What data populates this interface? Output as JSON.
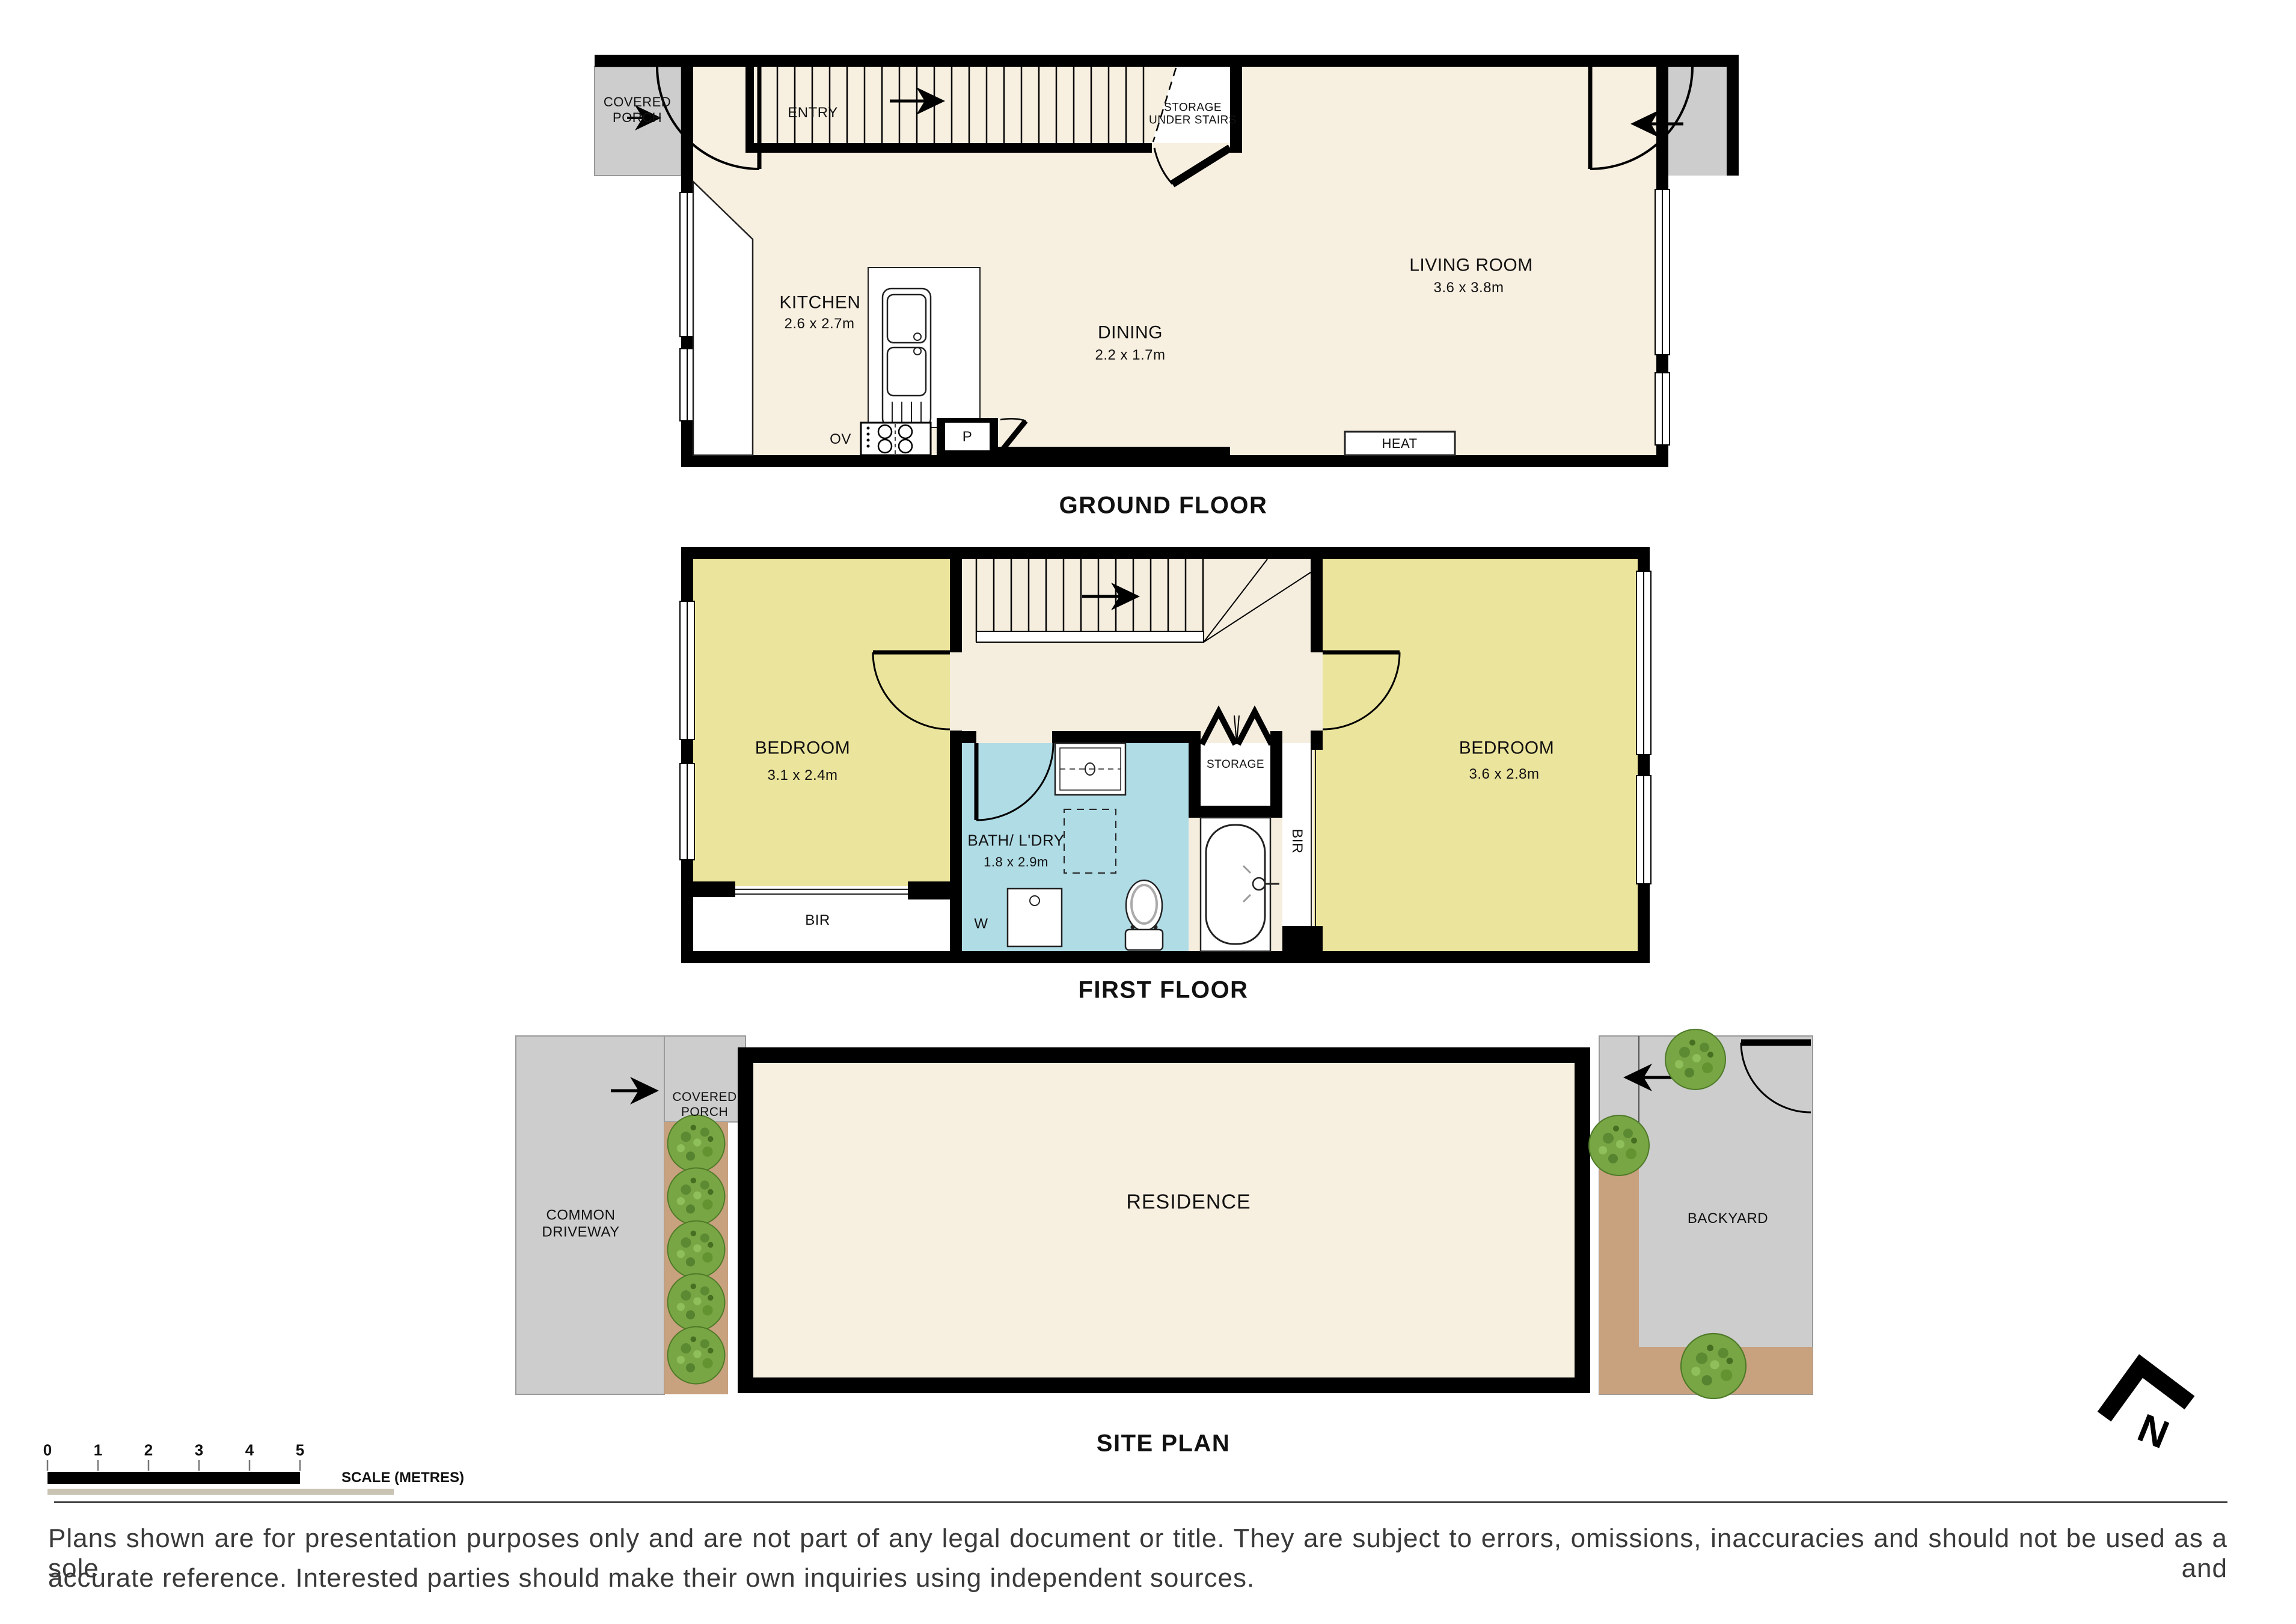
{
  "ground_floor": {
    "title": "GROUND FLOOR",
    "covered_porch": "COVERED\nPORCH",
    "entry": "ENTRY",
    "storage_under_stairs": "STORAGE\nUNDER STAIRS",
    "living_room": {
      "name": "LIVING ROOM",
      "dims": "3.6 x 3.8m"
    },
    "kitchen": {
      "name": "KITCHEN",
      "dims": "2.6 x 2.7m"
    },
    "dining": {
      "name": "DINING",
      "dims": "2.2 x 1.7m"
    },
    "oven": "OV",
    "pantry": "P",
    "heater": "HEAT"
  },
  "first_floor": {
    "title": "FIRST FLOOR",
    "bedroom_left": {
      "name": "BEDROOM",
      "dims": "3.1 x 2.4m"
    },
    "bedroom_right": {
      "name": "BEDROOM",
      "dims": "3.6 x 2.8m"
    },
    "bath": {
      "name": "BATH/ L'DRY",
      "dims": "1.8 x 2.9m"
    },
    "storage": "STORAGE",
    "bir_right": "BIR",
    "bir_left": "BIR",
    "washer": "W"
  },
  "site_plan": {
    "title": "SITE PLAN",
    "covered_porch": "COVERED\nPORCH",
    "common_driveway": "COMMON\nDRIVEWAY",
    "residence": "RESIDENCE",
    "backyard": "BACKYARD"
  },
  "scale_bar": {
    "ticks": [
      "0",
      "1",
      "2",
      "3",
      "4",
      "5"
    ],
    "label": "SCALE (METRES)"
  },
  "north": {
    "label": "N"
  },
  "disclaimer": {
    "line1": "Plans shown are for presentation purposes only and are not part of any legal document or title. They are subject to errors, omissions, inaccuracies and should not be used as a sole and",
    "line2": "accurate reference. Interested parties should make their own inquiries using independent sources."
  },
  "colors": {
    "floor": "#f7efe0",
    "bedroom": "#ebe49c",
    "bath": "#b0dce6",
    "porch_gray": "#cdcdcd",
    "garden_brown": "#c8a17e",
    "tree_green": "#79a644",
    "wall": "#000000"
  }
}
